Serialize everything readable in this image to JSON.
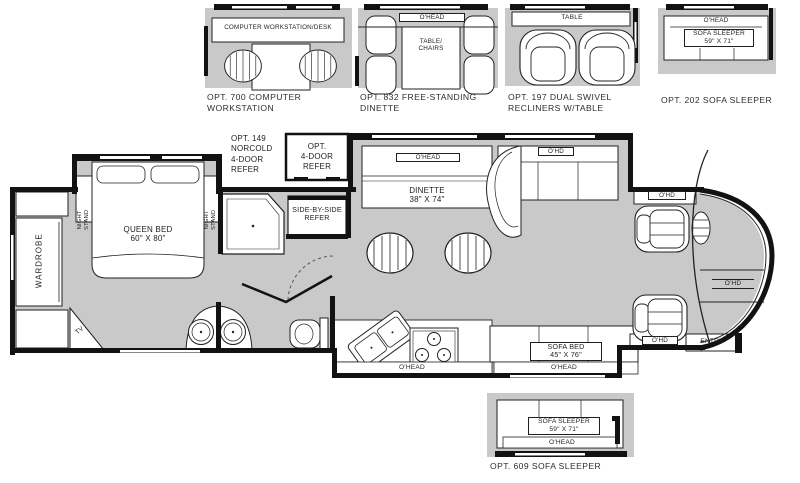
{
  "palette": {
    "floor": "#c8c9c8",
    "wall": "#121212",
    "furniture": "#ffffff",
    "label": "#1f1f1f"
  },
  "top_options": [
    {
      "caption": [
        "OPT. 700 COMPUTER",
        "WORKSTATION"
      ],
      "desk_label": "COMPUTER WORKSTATION/DESK"
    },
    {
      "caption": [
        "OPT. 832 FREE-STANDING",
        "DINETTE"
      ],
      "ohead": "O'HEAD",
      "table": [
        "TABLE/",
        "CHAIRS"
      ]
    },
    {
      "caption": [
        "OPT. 197 DUAL SWIVEL",
        "RECLINERS W/TABLE"
      ],
      "table": "TABLE"
    },
    {
      "caption": [
        "OPT. 202 SOFA SLEEPER"
      ],
      "ohead": "O'HEAD",
      "sofa": [
        "SOFA SLEEPER",
        "59\" X 71\""
      ]
    }
  ],
  "bottom_option": {
    "caption": "OPT. 609 SOFA SLEEPER",
    "sofa": [
      "SOFA SLEEPER",
      "59\" X 71\""
    ],
    "ohead": "O'HEAD"
  },
  "plan": {
    "wardrobe": "WARDROBE",
    "night_stand": [
      "NIGHT",
      "STAND"
    ],
    "queen_bed": [
      "QUEEN BED",
      "60\" X 80\""
    ],
    "tv": "TV",
    "opt149": [
      "OPT. 149",
      "NORCOLD",
      "4-DOOR",
      "REFER"
    ],
    "opt4door": [
      "OPT.",
      "4-DOOR",
      "REFER"
    ],
    "side_refer": [
      "SIDE-BY-SIDE",
      "REFER"
    ],
    "dinette_ohead": "O'HEAD",
    "dinette": [
      "DINETTE",
      "38\" X 74\""
    ],
    "sofa_ohd": "O'HD",
    "driver_ohd": "O'HD",
    "front_ohd": "O'HD",
    "passenger_ohd": "O'HD",
    "entry": "ENTRY",
    "kitchen_ohead": "O'HEAD",
    "sofa_bed": [
      "SOFA BED",
      "45\" X 76\""
    ],
    "sofa_bed_ohead": "O'HEAD"
  }
}
